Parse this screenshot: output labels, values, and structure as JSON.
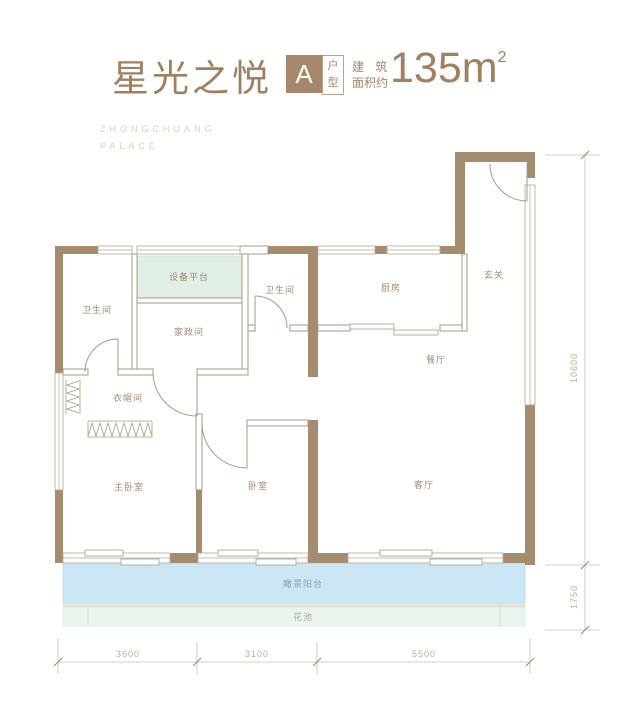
{
  "header": {
    "title": "星光之悦",
    "unit_letter": "A",
    "unit_suffix": "户型",
    "area_label_line1": "建 筑",
    "area_label_line2": "面积约",
    "area_value": "135m",
    "area_superscript": "2",
    "watermark_line1": "ZHONGCHUANG",
    "watermark_line2": "PALACE"
  },
  "rooms": {
    "bathroom1": {
      "label": "卫生间"
    },
    "equipment_platform": {
      "label": "设备平台"
    },
    "housekeeping": {
      "label": "家政间"
    },
    "bathroom2": {
      "label": "卫生间"
    },
    "kitchen": {
      "label": "厨房"
    },
    "entry": {
      "label": "玄关"
    },
    "dining": {
      "label": "餐厅"
    },
    "living": {
      "label": "客厅"
    },
    "closet": {
      "label": "衣帽间"
    },
    "master_bedroom": {
      "label": "主卧室"
    },
    "bedroom": {
      "label": "卧室"
    },
    "balcony": {
      "label": "瞰景阳台"
    },
    "flower_bed": {
      "label": "花池"
    }
  },
  "dimensions": {
    "bottom_left": "3600",
    "bottom_middle": "3100",
    "bottom_right": "5500",
    "right_height": "10600",
    "right_balcony": "1750"
  },
  "colors": {
    "wall": "#A68C6E",
    "accent_title": "#A1805F",
    "balcony_fill": "#CBE7F5",
    "platform_fill": "#E2EFE7",
    "flower_bed_fill": "#EAF5EE"
  }
}
